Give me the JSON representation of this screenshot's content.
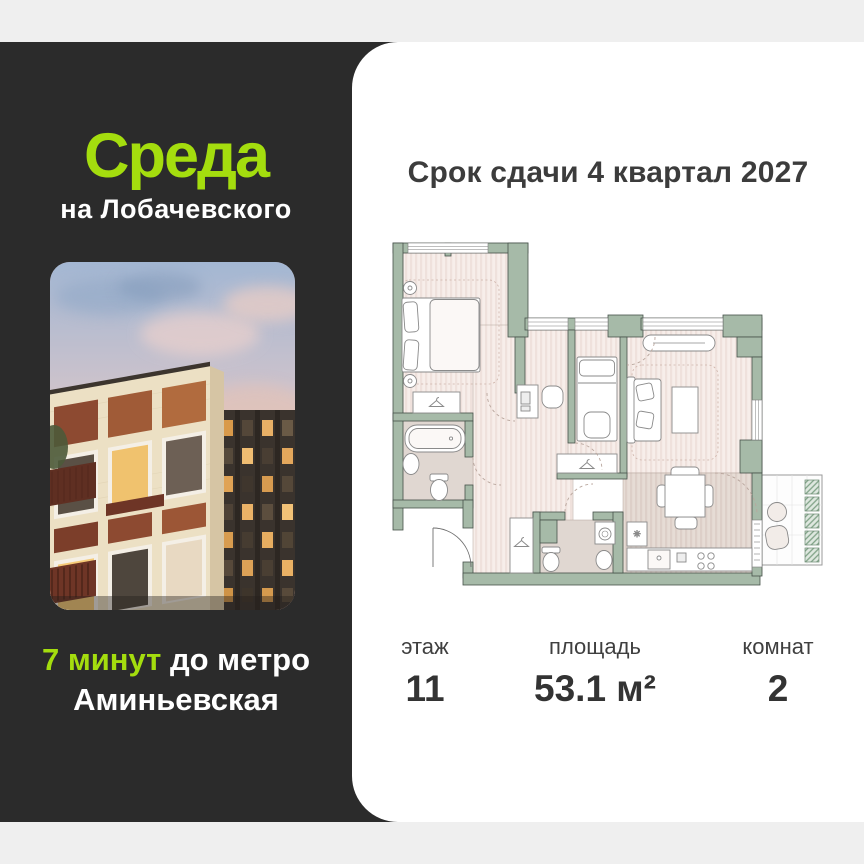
{
  "card": {
    "background_color": "#efefef",
    "dark_panel_color": "#2b2b2b",
    "accent_green": "#a4dd0e"
  },
  "left_panel": {
    "logo": "Среда",
    "logo_sub": "на Лобачевского",
    "metro_highlight": "7 минут",
    "metro_rest": " до метро",
    "metro_line2": "Аминьевская"
  },
  "right_panel": {
    "title": "Срок сдачи 4 квартал 2027",
    "stats": [
      {
        "label": "этаж",
        "value": "11"
      },
      {
        "label": "площадь",
        "value": "53.1 м²"
      },
      {
        "label": "комнат",
        "value": "2"
      }
    ]
  },
  "floor_plan": {
    "type": "apartment-2-rooms",
    "wall_color": "#a6baa8",
    "floor_color": "#f6ece7",
    "wet_floor_color": "#e0d7d1",
    "kitchen_floor_color": "#e4dad3",
    "balcony_tile_color": "#7fa186"
  }
}
